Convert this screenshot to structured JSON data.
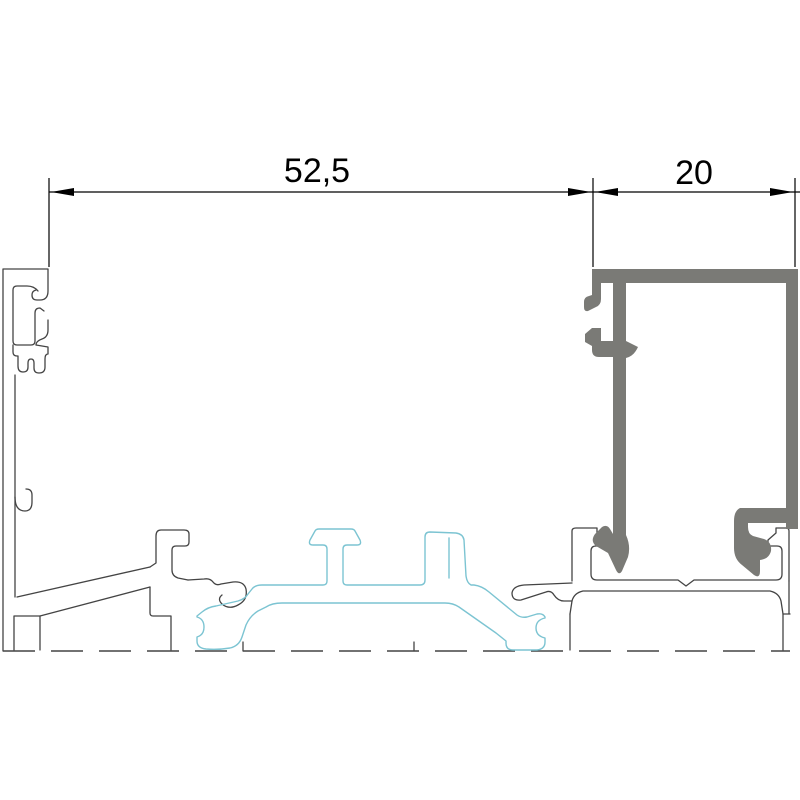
{
  "drawing": {
    "type": "cad-profile-cross-section",
    "dimensions": [
      {
        "id": "frame-width",
        "label": "52,5",
        "value": 52.5
      },
      {
        "id": "bead-width",
        "label": "20",
        "value": 20
      }
    ],
    "colors": {
      "background": "#ffffff",
      "profile_outline": "#444444",
      "dimension": "#000000",
      "bead_fill": "#7a7a76",
      "gasket_line": "#7cc4d2"
    },
    "components": [
      {
        "name": "frame-profile",
        "style": "thin-outline"
      },
      {
        "name": "sill-profile",
        "style": "thin-outline-dashed-base"
      },
      {
        "name": "glazing-bead-profile",
        "style": "solid-gray"
      },
      {
        "name": "gasket-seal",
        "style": "cyan-outline"
      }
    ]
  }
}
